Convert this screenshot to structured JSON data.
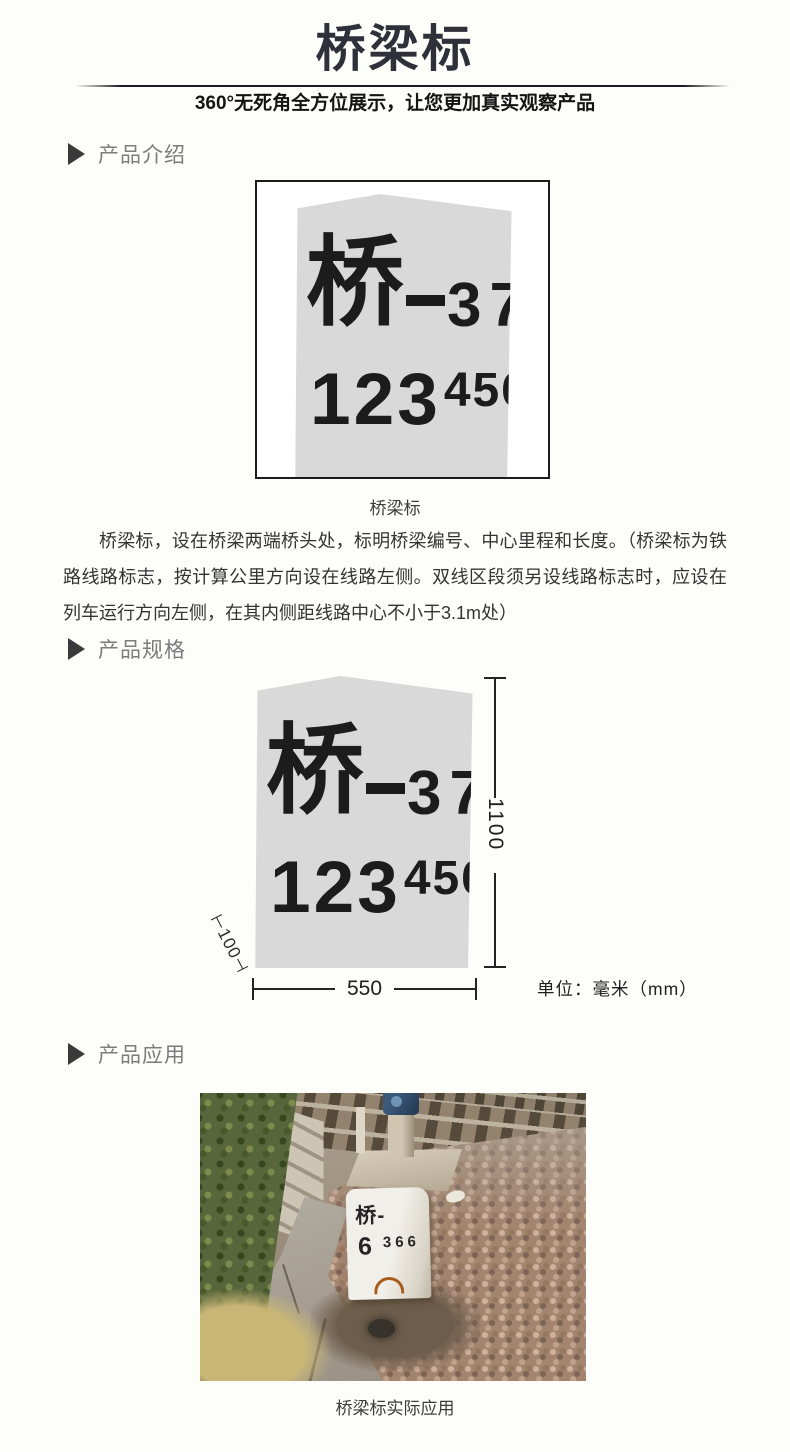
{
  "header": {
    "title": "桥梁标",
    "subtitle": "360°无死角全方位展示，让您更加真实观察产品"
  },
  "sections": {
    "intro": "产品介绍",
    "spec": "产品规格",
    "application": "产品应用"
  },
  "marker_sign": {
    "glyph": "桥",
    "dash": "—",
    "serial": "37",
    "mileage_main": "123",
    "mileage_sup": "456"
  },
  "intro": {
    "caption": "桥梁标",
    "paragraph": "桥梁标，设在桥梁两端桥头处，标明桥梁编号、中心里程和长度。（桥梁标为铁路线路标志，按计算公里方向设在线路左侧。双线区段须另设线路标志时，应设在列车运行方向左侧，在其内侧距线路中心不小于3.1m处）"
  },
  "spec": {
    "height_mm": "1100",
    "width_mm": "550",
    "side_dim": "⊢100⊣",
    "unit": "单位：毫米（mm）"
  },
  "application": {
    "stone_line1": "桥-",
    "stone_num_big": "6",
    "stone_num_small": "366",
    "caption": "桥梁标实际应用"
  },
  "colors": {
    "title_ink": "#30303a",
    "divider": "#1b1b22",
    "section_label": "#7c7c7c",
    "body_text": "#333333",
    "stone_fill": "#d9d9d9",
    "stone_ink": "#1c1c1c",
    "dimension_ink": "#242424"
  }
}
